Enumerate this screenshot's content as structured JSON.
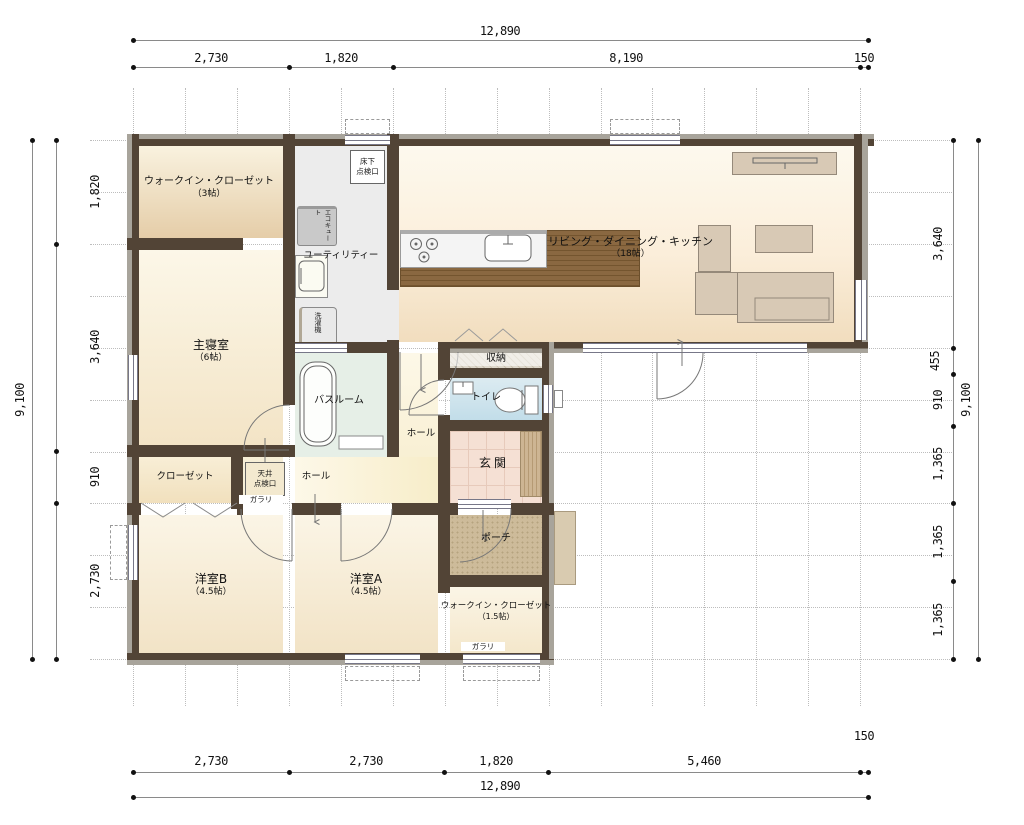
{
  "rooms": {
    "wic3": {
      "name": "ウォークイン・クローゼット",
      "size": "（3帖）"
    },
    "master": {
      "name": "主寝室",
      "size": "（6帖）"
    },
    "ldk": {
      "name": "リビング・ダイニング・キッチン",
      "size": "（18帖）"
    },
    "utility": {
      "name": "ユーティリティー"
    },
    "bath": {
      "name": "バスルーム"
    },
    "storage": {
      "name": "収納"
    },
    "toilet": {
      "name": "トイレ"
    },
    "hall_upper": {
      "name": "ホール"
    },
    "hall_lower": {
      "name": "ホール"
    },
    "closet": {
      "name": "クローゼット"
    },
    "genkan": {
      "name": "玄関"
    },
    "porch": {
      "name": "ポーチ"
    },
    "room_a": {
      "name": "洋室A",
      "size": "（4.5帖）"
    },
    "room_b": {
      "name": "洋室B",
      "size": "（4.5帖）"
    },
    "wic15": {
      "name": "ウォークイン・クローゼット",
      "size": "（1.5帖）"
    }
  },
  "features": {
    "floor_hatch": "床下\n点検口",
    "ceiling_hatch": "天井\n点検口",
    "ecocute": "エコキュート",
    "washer": "洗濯機",
    "louver_a": "ガラリ",
    "louver_b": "ガラリ"
  },
  "dims": {
    "top": {
      "total": "12,890",
      "segments": [
        "2,730",
        "1,820",
        "8,190",
        "150"
      ]
    },
    "bottom": {
      "total": "12,890",
      "segments": [
        "2,730",
        "2,730",
        "1,820",
        "5,460"
      ],
      "offset": "150"
    },
    "left": {
      "total": "9,100",
      "segments": [
        "1,820",
        "3,640",
        "910",
        "2,730"
      ]
    },
    "right": {
      "total": "9,100",
      "segments": [
        "3,640",
        "455",
        "910",
        "1,365",
        "1,365",
        "1,365"
      ]
    }
  },
  "colors": {
    "wall": "#524436",
    "step_accent": "#d9b94e"
  }
}
